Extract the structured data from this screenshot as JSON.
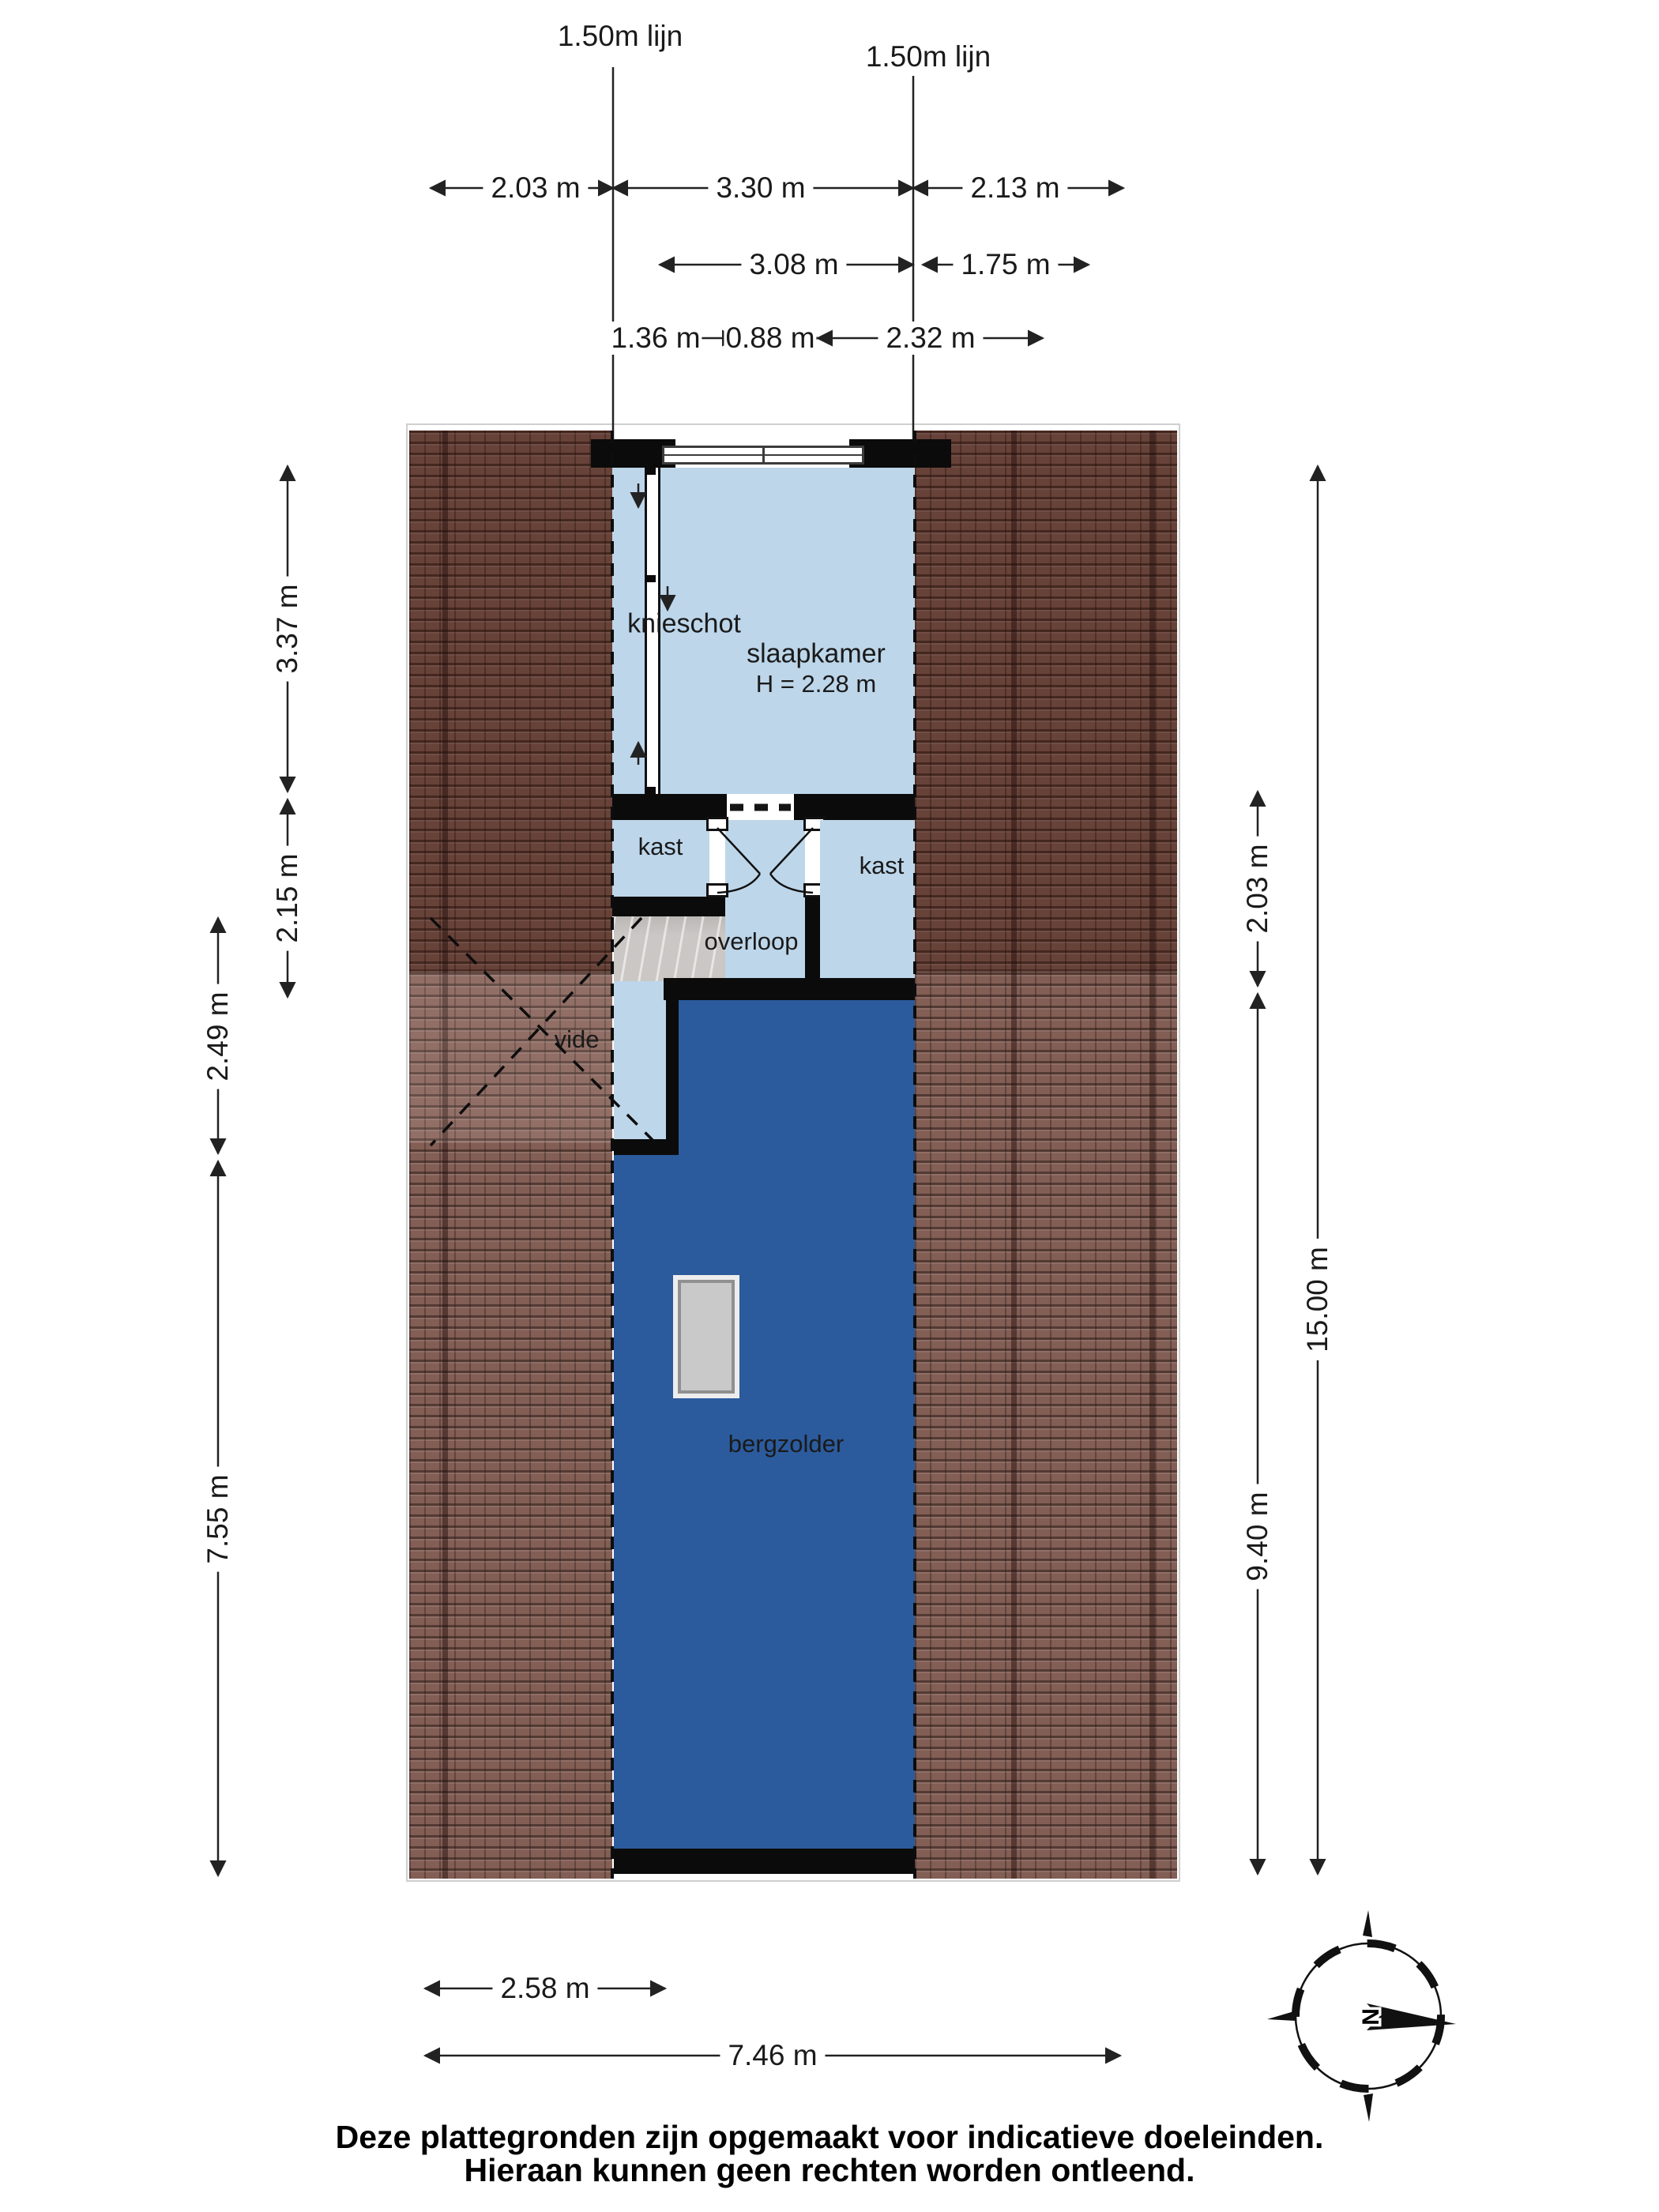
{
  "title_lines": {
    "left": "1.50m lijn",
    "right": "1.50m lijn"
  },
  "rooms": {
    "knieschot": "knieschot",
    "slaapkamer": "slaapkamer",
    "slaapkamer_height": "H = 2.28 m",
    "kast_left": "kast",
    "kast_right": "kast",
    "overloop": "overloop",
    "vide": "vide",
    "bergzolder": "bergzolder"
  },
  "dims": {
    "top1": [
      "2.03 m",
      "3.30 m",
      "2.13 m"
    ],
    "top2": [
      "3.08 m",
      "1.75 m"
    ],
    "top3": [
      "1.36 m",
      "0.88 m",
      "2.32 m"
    ],
    "left_inner": [
      "3.37 m",
      "2.15 m"
    ],
    "left_outer": [
      "2.49 m",
      "7.55 m"
    ],
    "right_inner": [
      "2.03 m",
      "9.40 m"
    ],
    "right_outer": [
      "15.00 m"
    ],
    "bottom": [
      "2.58 m",
      "7.46 m"
    ]
  },
  "compass": {
    "north": "N"
  },
  "footer": {
    "line1": "Deze plattegronden zijn opgemaakt voor indicatieve doeleinden.",
    "line2": "Hieraan kunnen geen rechten worden ontleend."
  },
  "colors": {
    "light_room": "#bdd6ea",
    "dark_room": "#2b5b9d",
    "wall": "#0b0b0b",
    "roof_base": "#7b544b",
    "stairs": "#cac7c4",
    "skylight": "#c9c9c9",
    "dim": "#222222",
    "text": "#1a1a1a"
  }
}
